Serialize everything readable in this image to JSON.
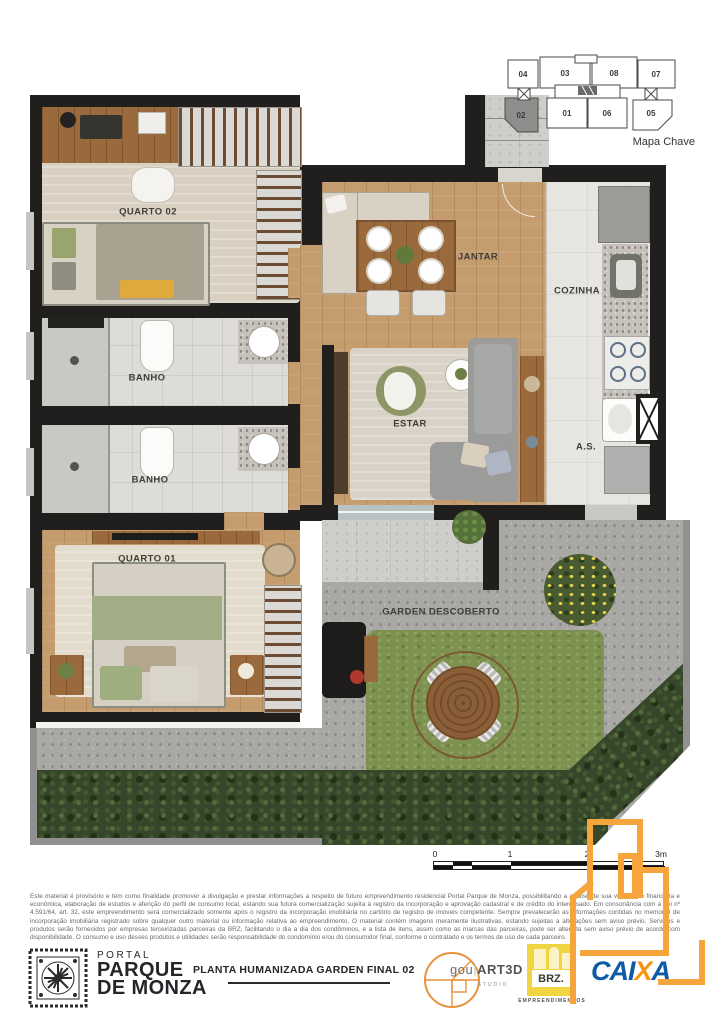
{
  "mapa_chave": {
    "caption": "Mapa Chave",
    "units": [
      "04",
      "03",
      "08",
      "07",
      "02",
      "01",
      "06",
      "05"
    ],
    "highlighted_unit": "02"
  },
  "rooms": {
    "quarto02": "QUARTO 02",
    "banho1": "BANHO",
    "banho2": "BANHO",
    "quarto01": "QUARTO 01",
    "jantar": "JANTAR",
    "cozinha": "COZINHA",
    "estar": "ESTAR",
    "area_servico": "A.S.",
    "garden": "GARDEN DESCOBERTO"
  },
  "scale_bar": {
    "ticks": [
      "0",
      "1",
      "2",
      "3m"
    ]
  },
  "disclaimer": {
    "text": "Este material é provisório e tem como finalidade promover a divulgação e prestar informações a respeito de futuro empreendimento residencial Portal Parque de Monza, possibilitando a análise de sua viabilidade financeira e econômica, elaboração de estudos e aferição do perfil de consumo local, estando sua futura comercialização sujeita à registro da incorporação e aprovação cadastral e de crédito do interessado. Em consonância com a Lei nº 4.591/64, art. 32, este empreendimento será comercializado somente após o registro da incorporação imobiliária no cartório de registro de imóveis competente. Sempre prevalecerão as informações contidas no memorial de incorporação imobiliária registrado sobre qualquer outro material ou informação relativa ao empreendimento. O material contém imagens meramente ilustrativas, estando sujeitas a alterações sem aviso prévio. Serviços e produtos serão fornecidos por empresas terceirizadas parceiras da BRZ, facilitando o dia a dia dos condôminos, e a lista de itens, assim como as marcas das parceiras, pode ser alterada sem aviso prévio de acordo com disponibilidade. O consumo e uso desses produtos e utilidades serão responsabilidade do condomínio e/ou do consumidor final, conforme o contratado e os termos de uso de cada parceiro."
  },
  "footer": {
    "brand_small": "PORTAL",
    "brand_line1": "PARQUE",
    "brand_line2": "DE MONZA",
    "plan_title": "PLANTA HUMANIZADA GARDEN FINAL 02",
    "studio_left": "gou",
    "studio_right": "ART3D",
    "studio_sub": "STUDIO",
    "brz_name": "BRZ.",
    "brz_sub": "EMPREENDIMENTOS",
    "caixa": {
      "left": "CAI",
      "x": "X",
      "right": "A"
    }
  },
  "colors": {
    "wall": "#201f1d",
    "wood_floor": "#c49c6e",
    "concrete": "#a9a8a5",
    "grass": "#7d9150",
    "hedge": "#35462a",
    "watermark_orange": "#f5a53b",
    "caixa_blue": "#0e5aa7",
    "caixa_orange": "#f6930f",
    "brz_yellow": "#f0d442"
  }
}
